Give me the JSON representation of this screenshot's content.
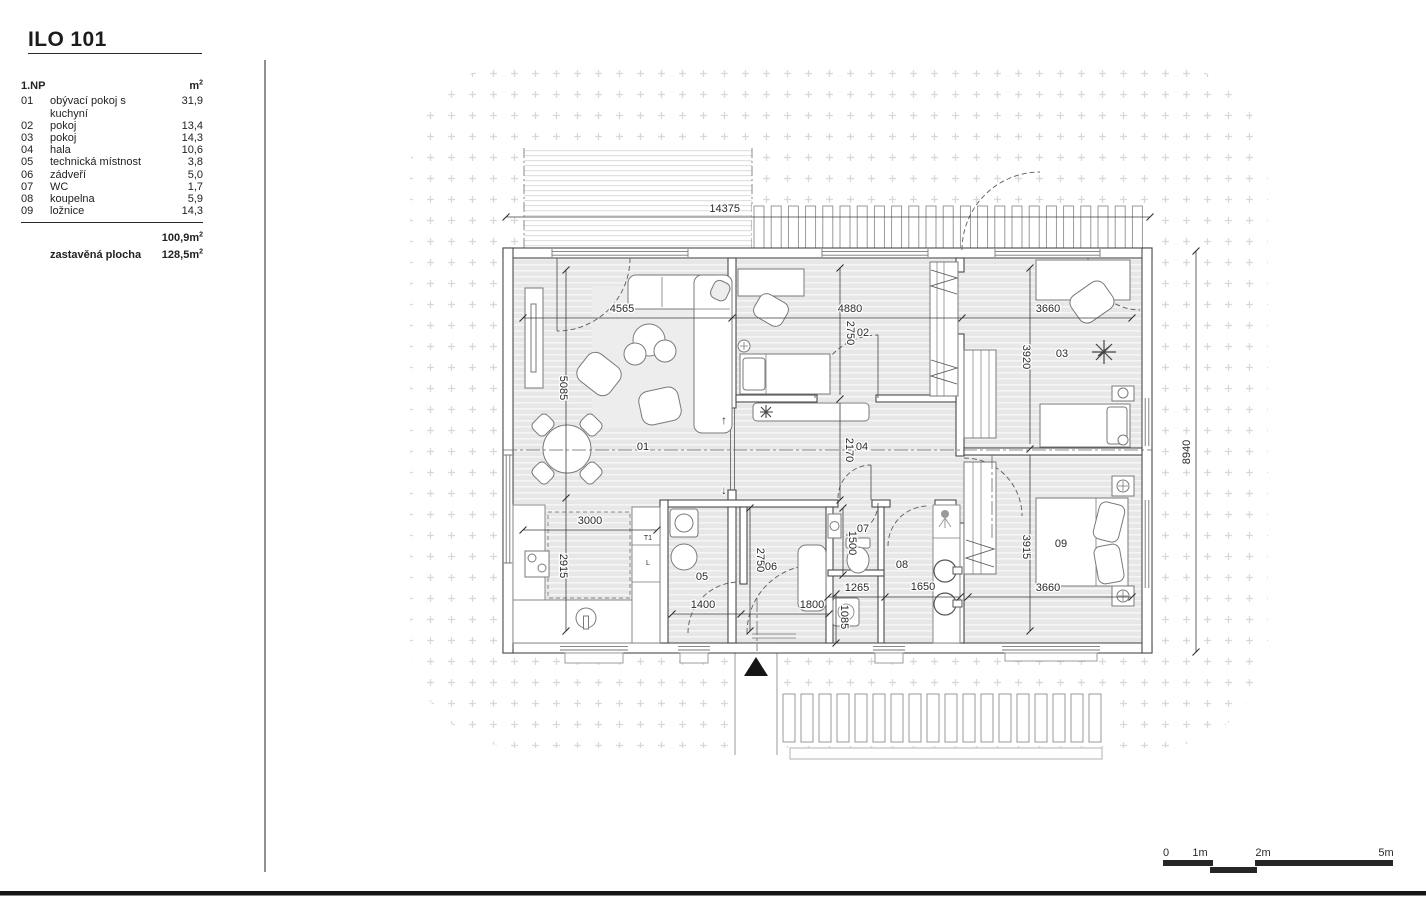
{
  "title": "ILO 101",
  "legend": {
    "floor_label": "1.NP",
    "unit_label": "m",
    "unit_sup": "2",
    "rows": [
      {
        "no": "01",
        "name": "obývací pokoj s kuchyní",
        "area": "31,9"
      },
      {
        "no": "02",
        "name": "pokoj",
        "area": "13,4"
      },
      {
        "no": "03",
        "name": "pokoj",
        "area": "14,3"
      },
      {
        "no": "04",
        "name": "hala",
        "area": "10,6"
      },
      {
        "no": "05",
        "name": "technická místnost",
        "area": "3,8"
      },
      {
        "no": "06",
        "name": "zádveří",
        "area": "5,0"
      },
      {
        "no": "07",
        "name": "WC",
        "area": "1,7"
      },
      {
        "no": "08",
        "name": "koupelna",
        "area": "5,9"
      },
      {
        "no": "09",
        "name": "ložnice",
        "area": "14,3"
      }
    ],
    "total": {
      "value": "100,9",
      "unit": "m",
      "sup": "2"
    },
    "built": {
      "label": "zastavěná plocha",
      "value": "128,5",
      "unit": "m",
      "sup": "2"
    }
  },
  "plan": {
    "labels": [
      {
        "text": "14375",
        "x": 740,
        "y": 212,
        "anchor": "end",
        "name": "dim-label"
      },
      {
        "text": "4565",
        "x": 622,
        "y": 312,
        "name": "dim-label"
      },
      {
        "text": "4880",
        "x": 850,
        "y": 312,
        "name": "dim-label"
      },
      {
        "text": "3660",
        "x": 1048,
        "y": 312,
        "name": "dim-label"
      },
      {
        "text": "5085",
        "x": 560,
        "y": 388,
        "rot": 90,
        "name": "dim-label"
      },
      {
        "text": "2750",
        "x": 847,
        "y": 333,
        "rot": 90,
        "name": "dim-label"
      },
      {
        "text": "3920",
        "x": 1023,
        "y": 357,
        "rot": 90,
        "name": "dim-label"
      },
      {
        "text": "2170",
        "x": 846,
        "y": 450,
        "rot": 90,
        "name": "dim-label"
      },
      {
        "text": "2915",
        "x": 560,
        "y": 566,
        "rot": 90,
        "name": "dim-label"
      },
      {
        "text": "3000",
        "x": 590,
        "y": 524,
        "name": "dim-label"
      },
      {
        "text": "1400",
        "x": 703,
        "y": 608,
        "name": "dim-label"
      },
      {
        "text": "1800",
        "x": 812,
        "y": 608,
        "name": "dim-label"
      },
      {
        "text": "2750",
        "x": 757,
        "y": 560,
        "rot": 90,
        "name": "dim-label"
      },
      {
        "text": "1500",
        "x": 849,
        "y": 543,
        "rot": 90,
        "name": "dim-label"
      },
      {
        "text": "1265",
        "x": 857,
        "y": 591,
        "name": "dim-label"
      },
      {
        "text": "1085",
        "x": 841,
        "y": 617,
        "rot": 90,
        "name": "dim-label"
      },
      {
        "text": "1650",
        "x": 923,
        "y": 590,
        "name": "dim-label"
      },
      {
        "text": "3915",
        "x": 1023,
        "y": 547,
        "rot": 90,
        "name": "dim-label"
      },
      {
        "text": "3660",
        "x": 1048,
        "y": 591,
        "name": "dim-label"
      },
      {
        "text": "8940",
        "x": 1190,
        "y": 452,
        "rot": -90,
        "name": "dim-label"
      },
      {
        "text": "01",
        "x": 643,
        "y": 450,
        "name": "room-label"
      },
      {
        "text": "02",
        "x": 863,
        "y": 336,
        "name": "room-label"
      },
      {
        "text": "03",
        "x": 1062,
        "y": 357,
        "name": "room-label"
      },
      {
        "text": "04",
        "x": 862,
        "y": 450,
        "name": "room-label"
      },
      {
        "text": "05",
        "x": 702,
        "y": 580,
        "name": "room-label"
      },
      {
        "text": "06",
        "x": 771,
        "y": 570,
        "name": "room-label"
      },
      {
        "text": "07",
        "x": 863,
        "y": 532,
        "name": "room-label"
      },
      {
        "text": "08",
        "x": 902,
        "y": 568,
        "name": "room-label"
      },
      {
        "text": "09",
        "x": 1061,
        "y": 547,
        "name": "room-label"
      },
      {
        "text": "↑",
        "x": 724,
        "y": 424,
        "size": 12,
        "name": "level-arrow-up"
      },
      {
        "text": "↓",
        "x": 724,
        "y": 494,
        "size": 12,
        "name": "level-arrow-down"
      },
      {
        "text": "T1",
        "x": 648,
        "y": 540,
        "size": 7,
        "color": "#8a8a8a",
        "name": "cabinet-label"
      },
      {
        "text": "L",
        "x": 648,
        "y": 565,
        "size": 7,
        "color": "#8a8a8a",
        "name": "cabinet-label"
      },
      {
        "text": "0",
        "x": 1166,
        "y": 856,
        "name": "scale-label"
      },
      {
        "text": "1m",
        "x": 1200,
        "y": 856,
        "name": "scale-label"
      },
      {
        "text": "2m",
        "x": 1263,
        "y": 856,
        "name": "scale-label"
      },
      {
        "text": "5m",
        "x": 1386,
        "y": 856,
        "name": "scale-label"
      }
    ]
  }
}
